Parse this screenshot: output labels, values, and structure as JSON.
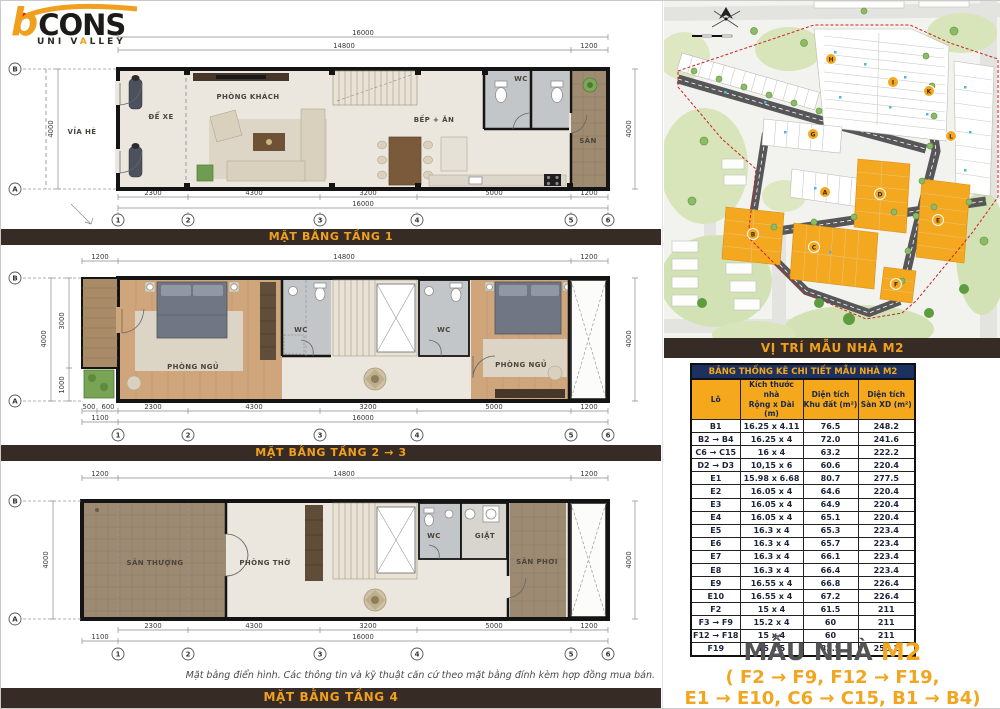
{
  "logo": {
    "b": "b",
    "cons": "CONS",
    "sub_pre": "UNI V",
    "sub_a": "A",
    "sub_post": "LLEY"
  },
  "floors": [
    {
      "title": "MẶT BẰNG TẦNG 1",
      "dim_total_top": "16000",
      "dim_main": "14800",
      "dim_side": "1200",
      "bottom": [
        "2300",
        "4300",
        "3200",
        "5000",
        "1200"
      ],
      "bottom_total": "16000",
      "left_dim": "4000",
      "right_dim": "4000",
      "cols": [
        "1",
        "2",
        "3",
        "4",
        "5",
        "6"
      ],
      "row_top": "B",
      "row_bottom": "A",
      "rooms": {
        "sidewalk": "VỈA HÈ",
        "parking": "ĐỂ XE",
        "living": "PHÒNG KHÁCH",
        "kitchen": "BẾP + ĂN",
        "wc": "WC",
        "yard": "SÂN"
      }
    },
    {
      "title": "MẶT BẰNG TẦNG 2 → 3",
      "dim_balcony": "1200",
      "dim_main": "14800",
      "dim_side": "1200",
      "bottom": [
        "500",
        "600",
        "2300",
        "4300",
        "3200",
        "5000",
        "1200"
      ],
      "bottom2": [
        "1100",
        "16000"
      ],
      "left_dim": "4000",
      "left_sub_top": "3000",
      "left_sub_bottom": "1000",
      "right_dim": "4000",
      "cols": [
        "1",
        "2",
        "3",
        "4",
        "5",
        "6"
      ],
      "row_top": "B",
      "row_bottom": "A",
      "rooms": {
        "bed1": "PHÒNG NGỦ",
        "wc1": "WC",
        "wc2": "WC",
        "bed2": "PHÒNG NGỦ"
      }
    },
    {
      "title": "MẶT BẰNG TẦNG 4",
      "dim_balcony": "1200",
      "dim_main": "14800",
      "dim_side": "1200",
      "bottom": [
        "2300",
        "4300",
        "3200",
        "5000",
        "1200"
      ],
      "bottom2": [
        "1100",
        "16000"
      ],
      "left_dim": "4000",
      "right_dim": "4000",
      "cols": [
        "1",
        "2",
        "3",
        "4",
        "5",
        "6"
      ],
      "row_top": "B",
      "row_bottom": "A",
      "rooms": {
        "terrace": "SÂN THƯỢNG",
        "worship": "PHÒNG THỜ",
        "wc": "WC",
        "laundry": "GIẶT",
        "drying": "SÂN PHƠI"
      }
    }
  ],
  "note": "Mặt bằng điển hình. Các thông tin và kỹ thuật căn cứ theo mặt bằng đính kèm hợp đồng mua bán.",
  "map": {
    "title": "VỊ TRÍ MẪU NHÀ M2",
    "badges": [
      "H",
      "I",
      "K",
      "L",
      "G",
      "A",
      "D",
      "B",
      "C",
      "E",
      "F"
    ]
  },
  "table": {
    "title": "BẢNG THỐNG KÊ CHI TIẾT MẪU NHÀ M2",
    "headers": [
      {
        "l1": "Lô",
        "l2": ""
      },
      {
        "l1": "Kích thước nhà",
        "l2": "Rộng x Dài (m)"
      },
      {
        "l1": "Diện tích",
        "l2": "Khu đất (m²)"
      },
      {
        "l1": "Diện tích",
        "l2": "Sàn XD (m²)"
      }
    ],
    "rows": [
      [
        "B1",
        "16.25 x 4.11",
        "76.5",
        "248.2"
      ],
      [
        "B2 → B4",
        "16.25 x 4",
        "72.0",
        "241.6"
      ],
      [
        "C6 → C15",
        "16 x 4",
        "63.2",
        "222.2"
      ],
      [
        "D2 → D3",
        "10,15 x 6",
        "60.6",
        "220.4"
      ],
      [
        "E1",
        "15.98 x 6.68",
        "80.7",
        "277.5"
      ],
      [
        "E2",
        "16.05 x 4",
        "64.6",
        "220.4"
      ],
      [
        "E3",
        "16.05 x 4",
        "64.9",
        "220.4"
      ],
      [
        "E4",
        "16.05 x 4",
        "65.1",
        "220.4"
      ],
      [
        "E5",
        "16.3 x 4",
        "65.3",
        "223.4"
      ],
      [
        "E6",
        "16.3 x 4",
        "65.7",
        "223.4"
      ],
      [
        "E7",
        "16.3 x 4",
        "66.1",
        "223.4"
      ],
      [
        "E8",
        "16.3 x 4",
        "66.4",
        "223.4"
      ],
      [
        "E9",
        "16.55 x 4",
        "66.8",
        "226.4"
      ],
      [
        "E10",
        "16.55 x 4",
        "67.2",
        "226.4"
      ],
      [
        "F2",
        "15 x 4",
        "61.5",
        "211"
      ],
      [
        "F3 → F9",
        "15.2 x 4",
        "60",
        "211"
      ],
      [
        "F12 → F18",
        "15 x 4",
        "60",
        "211"
      ],
      [
        "F19",
        "15 x 5",
        "82.5",
        "256.1"
      ]
    ]
  },
  "footer": {
    "title_main": "MẪU NHÀ",
    "title_code": "M2",
    "line1": "( F2 → F9, F12 → F19,",
    "line2": "E1 → E10, C6 → C15, B1 → B4)"
  }
}
